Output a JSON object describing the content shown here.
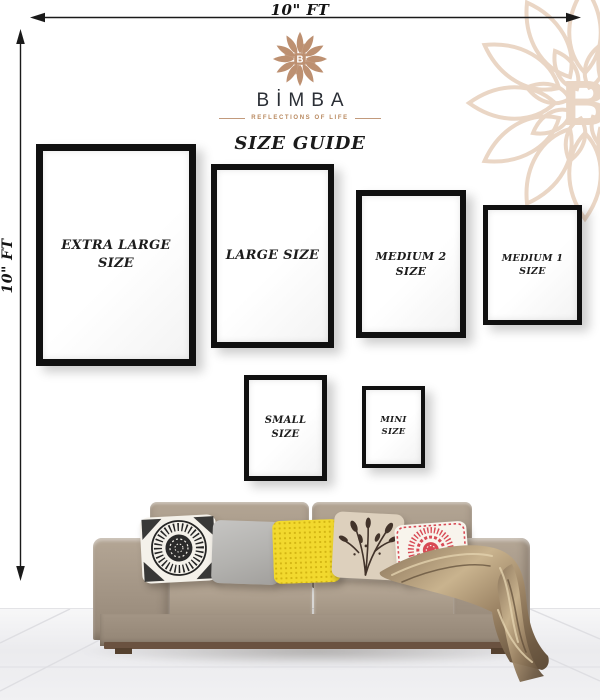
{
  "page": {
    "background": "#ffffff"
  },
  "measurements": {
    "top_width_label": "10\" FT",
    "left_height_label": "10\" FT"
  },
  "brand": {
    "name": "BİMBA",
    "monogram": "B",
    "tagline": "REFLECTIONS OF LIFE",
    "accent_color": "#b9895f",
    "watermark_color": "#ead6c5",
    "name_color": "#2b2f36"
  },
  "title": "SIZE GUIDE",
  "frames": [
    {
      "id": "extra-large",
      "label": "EXTRA LARGE\nSIZE"
    },
    {
      "id": "large",
      "label": "LARGE SIZE"
    },
    {
      "id": "medium-2",
      "label": "MEDIUM 2\nSIZE"
    },
    {
      "id": "medium-1",
      "label": "MEDIUM 1\nSIZE"
    },
    {
      "id": "small",
      "label": "SMALL\nSIZE"
    },
    {
      "id": "mini",
      "label": "MINI\nSIZE"
    }
  ],
  "scene": {
    "sofa": {
      "color": "#a49585",
      "cushion_color": "#b0a191",
      "plinth_color": "#6a5240"
    },
    "pillows": [
      {
        "name": "black-white-mandala-pillow",
        "base_color": "#f4f1ea",
        "pattern_color": "#242424"
      },
      {
        "name": "plain-gray-pillow",
        "base_color": "#b9b8b5",
        "pattern_color": "#a2a19e"
      },
      {
        "name": "yellow-dotted-pillow",
        "base_color": "#f2d92e",
        "pattern_color": "#d3b513"
      },
      {
        "name": "beige-botanical-pillow",
        "base_color": "#ddd0bd",
        "pattern_color": "#42332a"
      },
      {
        "name": "red-mandala-pillow",
        "base_color": "#f8f4ec",
        "pattern_color": "#d84a55"
      }
    ],
    "throw_blanket": {
      "name": "satin-throw-blanket",
      "color": "#9c8465"
    },
    "floor_color": "#f2f2f4"
  }
}
